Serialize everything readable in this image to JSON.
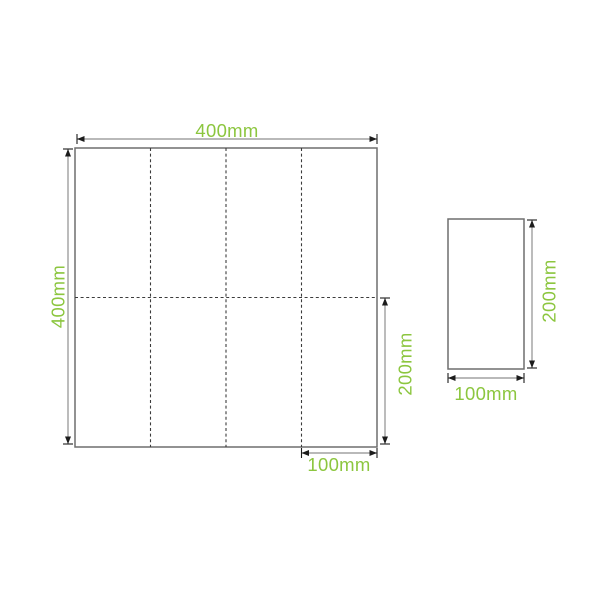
{
  "colors": {
    "label_green": "#8cc63f",
    "sheet_outline": "#6e6e6e",
    "fold_line": "#3c3c3c",
    "dim_line": "#8f8f8f",
    "arrow_dark": "#1c1c1c",
    "background": "#ffffff"
  },
  "labels": {
    "unfolded_width": "400mm",
    "unfolded_height": "400mm",
    "unfolded_half_height": "200mm",
    "unfolded_panel_width": "100mm",
    "folded_height": "200mm",
    "folded_width": "100mm"
  }
}
